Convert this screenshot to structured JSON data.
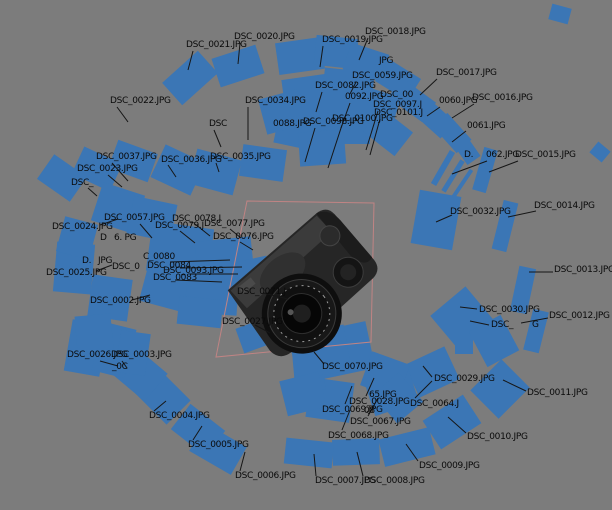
{
  "scene": {
    "width": 612,
    "height": 510,
    "background_color": "#7c7c7c",
    "plane_color": "#3b76b5",
    "label_text_color": "#0a0a0a",
    "leader_color": "#161616",
    "bbox_color": "#c08484",
    "model_description": "dslr-camera-3d-reconstruction"
  },
  "bbox": {
    "points": "247,201 374,203 371,342 216,357"
  },
  "planes": [
    [
      190,
      78,
      48,
      30,
      -42
    ],
    [
      238,
      66,
      46,
      30,
      -18
    ],
    [
      300,
      56,
      46,
      32,
      -8
    ],
    [
      336,
      52,
      42,
      30,
      6
    ],
    [
      366,
      62,
      40,
      28,
      18
    ],
    [
      560,
      14,
      20,
      16,
      15
    ],
    [
      398,
      80,
      38,
      26,
      32
    ],
    [
      412,
      100,
      42,
      24,
      36
    ],
    [
      433,
      117,
      40,
      22,
      42
    ],
    [
      452,
      133,
      36,
      20,
      48
    ],
    [
      466,
      149,
      28,
      16,
      55
    ],
    [
      443,
      168,
      6,
      38,
      30
    ],
    [
      453,
      176,
      5,
      36,
      32
    ],
    [
      462,
      184,
      4,
      34,
      34
    ],
    [
      436,
      220,
      42,
      54,
      10
    ],
    [
      485,
      170,
      14,
      44,
      16
    ],
    [
      505,
      226,
      15,
      50,
      14
    ],
    [
      523,
      290,
      17,
      46,
      12
    ],
    [
      536,
      331,
      16,
      42,
      14
    ],
    [
      500,
      389,
      44,
      40,
      -45
    ],
    [
      462,
      318,
      46,
      44,
      -40
    ],
    [
      494,
      341,
      40,
      36,
      62
    ],
    [
      432,
      372,
      44,
      36,
      -25
    ],
    [
      340,
      351,
      62,
      48,
      -12
    ],
    [
      464,
      345,
      18,
      18,
      0
    ],
    [
      391,
      390,
      46,
      40,
      -18
    ],
    [
      330,
      400,
      44,
      40,
      8
    ],
    [
      309,
      374,
      30,
      34,
      -5
    ],
    [
      452,
      422,
      48,
      34,
      -33
    ],
    [
      407,
      447,
      52,
      28,
      -14
    ],
    [
      356,
      452,
      47,
      26,
      -2
    ],
    [
      309,
      453,
      48,
      26,
      6
    ],
    [
      218,
      449,
      48,
      32,
      30
    ],
    [
      198,
      430,
      44,
      32,
      38
    ],
    [
      163,
      397,
      44,
      34,
      45
    ],
    [
      140,
      374,
      42,
      36,
      40
    ],
    [
      86,
      348,
      36,
      52,
      10
    ],
    [
      114,
      350,
      34,
      50,
      14
    ],
    [
      133,
      353,
      30,
      42,
      8
    ],
    [
      74,
      268,
      38,
      50,
      5
    ],
    [
      110,
      298,
      40,
      42,
      8
    ],
    [
      94,
      333,
      36,
      36,
      -5
    ],
    [
      77,
      238,
      34,
      36,
      15
    ],
    [
      62,
      178,
      40,
      30,
      35
    ],
    [
      97,
      169,
      42,
      30,
      25
    ],
    [
      133,
      161,
      42,
      30,
      20
    ],
    [
      178,
      170,
      44,
      36,
      25
    ],
    [
      215,
      172,
      46,
      36,
      15
    ],
    [
      263,
      163,
      44,
      32,
      8
    ],
    [
      118,
      208,
      44,
      40,
      18
    ],
    [
      152,
      219,
      44,
      38,
      12
    ],
    [
      180,
      250,
      62,
      50,
      8
    ],
    [
      225,
      262,
      56,
      46,
      -6
    ],
    [
      170,
      285,
      52,
      46,
      15
    ],
    [
      212,
      293,
      52,
      42,
      4
    ],
    [
      248,
      280,
      46,
      40,
      -12
    ],
    [
      200,
      312,
      44,
      28,
      6
    ],
    [
      312,
      97,
      56,
      42,
      -8
    ],
    [
      348,
      88,
      50,
      36,
      6
    ],
    [
      302,
      128,
      50,
      40,
      12
    ],
    [
      342,
      122,
      56,
      44,
      0
    ],
    [
      374,
      107,
      46,
      34,
      18
    ],
    [
      388,
      132,
      40,
      30,
      38
    ],
    [
      322,
      148,
      46,
      34,
      -4
    ],
    [
      282,
      112,
      40,
      36,
      -15
    ],
    [
      320,
      352,
      56,
      46,
      -10
    ],
    [
      303,
      394,
      40,
      36,
      -14
    ],
    [
      385,
      375,
      40,
      36,
      20
    ],
    [
      398,
      398,
      38,
      34,
      50
    ],
    [
      254,
      336,
      30,
      26,
      -20
    ],
    [
      600,
      152,
      16,
      14,
      40
    ]
  ],
  "labels": [
    {
      "text": "DSC_0021.JPG",
      "x": 186,
      "y": 40,
      "leader": [
        193,
        51,
        188,
        70
      ]
    },
    {
      "text": "DSC_0020.JPG",
      "x": 234,
      "y": 32,
      "leader": [
        240,
        43,
        238,
        64
      ]
    },
    {
      "text": "DSC_0018.JPG",
      "x": 365,
      "y": 27,
      "leader": [
        368,
        38,
        359,
        60
      ]
    },
    {
      "text": "DSC_0019.JPG",
      "x": 322,
      "y": 35,
      "leader": [
        323,
        46,
        320,
        67
      ]
    },
    {
      "text": "DSC_0017.JPG",
      "x": 436,
      "y": 68,
      "leader": [
        437,
        79,
        420,
        95
      ]
    },
    {
      "text": "DSC_0016.JPG",
      "x": 472,
      "y": 93,
      "leader": [
        474,
        104,
        452,
        118
      ]
    },
    {
      "text": "0060.JPG",
      "x": 439,
      "y": 96,
      "leader": [
        440,
        107,
        427,
        116
      ]
    },
    {
      "text": "0061.JPG",
      "x": 467,
      "y": 121,
      "leader": [
        466,
        131,
        452,
        142
      ]
    },
    {
      "text": "D.",
      "x": 464,
      "y": 150
    },
    {
      "text": "062.JPG",
      "x": 486,
      "y": 150,
      "leader": [
        487,
        161,
        452,
        174
      ]
    },
    {
      "text": "DSC_0015.JPG",
      "x": 515,
      "y": 150,
      "leader": [
        518,
        161,
        489,
        172
      ]
    },
    {
      "text": "DSC_0014.JPG",
      "x": 534,
      "y": 201,
      "leader": [
        536,
        211,
        508,
        217
      ]
    },
    {
      "text": "DSC_0032.JPG",
      "x": 450,
      "y": 207,
      "leader": [
        452,
        215,
        436,
        222
      ]
    },
    {
      "text": "DSC_0013.JPG",
      "x": 554,
      "y": 265,
      "leader": [
        553,
        272,
        529,
        272
      ]
    },
    {
      "text": "DSC_0030.JPG",
      "x": 479,
      "y": 305,
      "leader": [
        477,
        309,
        460,
        307
      ]
    },
    {
      "text": "DSC_0012.JPG",
      "x": 549,
      "y": 311,
      "leader": [
        548,
        318,
        521,
        323
      ]
    },
    {
      "text": "DSC_",
      "x": 491,
      "y": 320,
      "leader": [
        489,
        325,
        470,
        321
      ]
    },
    {
      "text": "G",
      "x": 532,
      "y": 320
    },
    {
      "text": "DSC_0011.JPG",
      "x": 527,
      "y": 388,
      "leader": [
        526,
        391,
        503,
        380
      ]
    },
    {
      "text": "DSC_0029.JPG",
      "x": 434,
      "y": 374,
      "leader": [
        432,
        377,
        423,
        366
      ]
    },
    {
      "text": "DSC_0010.JPG",
      "x": 467,
      "y": 432,
      "leader": [
        466,
        433,
        448,
        417
      ]
    },
    {
      "text": "DSC_0009.JPG",
      "x": 419,
      "y": 461,
      "leader": [
        418,
        461,
        406,
        444
      ]
    },
    {
      "text": "DSC_0008.JPG",
      "x": 364,
      "y": 476,
      "leader": [
        363,
        476,
        357,
        452
      ]
    },
    {
      "text": "DSC_0007.JPG",
      "x": 315,
      "y": 476,
      "leader": [
        316,
        476,
        314,
        454
      ]
    },
    {
      "text": "DSC_0006.JPG",
      "x": 235,
      "y": 471,
      "leader": [
        240,
        471,
        245,
        452
      ]
    },
    {
      "text": "DSC_0005.JPG",
      "x": 188,
      "y": 440,
      "leader": [
        193,
        440,
        202,
        426
      ]
    },
    {
      "text": "DSC_0004.JPG",
      "x": 149,
      "y": 411,
      "leader": [
        154,
        411,
        166,
        401
      ]
    },
    {
      "text": "DSC_0026.JPG",
      "x": 67,
      "y": 350,
      "leader": [
        100,
        361,
        118,
        366
      ]
    },
    {
      "text": "DSC_0003.JPG",
      "x": 111,
      "y": 350,
      "leader": [
        122,
        361,
        127,
        368
      ]
    },
    {
      "text": "_0C",
      "x": 112,
      "y": 362
    },
    {
      "text": "DSC_0025.JPG",
      "x": 46,
      "y": 268,
      "leader": [
        96,
        271,
        112,
        265
      ]
    },
    {
      "text": "DSC_0024.JPG",
      "x": 52,
      "y": 222,
      "leader": [
        100,
        225,
        118,
        219
      ]
    },
    {
      "text": "DSC_0023.JPG",
      "x": 77,
      "y": 164,
      "leader": [
        108,
        175,
        122,
        187
      ]
    },
    {
      "text": "DSC_0037.JPG",
      "x": 96,
      "y": 152,
      "leader": [
        112,
        163,
        128,
        181
      ]
    },
    {
      "text": "DSC_",
      "x": 71,
      "y": 178,
      "leader": [
        88,
        188,
        97,
        196
      ]
    },
    {
      "text": "DSC_0022.JPG",
      "x": 110,
      "y": 96,
      "leader": [
        117,
        107,
        128,
        122
      ]
    },
    {
      "text": "DSC_0036.JPG",
      "x": 161,
      "y": 155,
      "leader": [
        168,
        165,
        176,
        177
      ]
    },
    {
      "text": "DSC_0035.JPG",
      "x": 210,
      "y": 152,
      "leader": [
        216,
        163,
        219,
        172
      ]
    },
    {
      "text": "DSC_0034.JPG",
      "x": 245,
      "y": 96,
      "leader": [
        248,
        107,
        248,
        140
      ]
    },
    {
      "text": "DSC",
      "x": 209,
      "y": 119,
      "leader": [
        214,
        130,
        221,
        147
      ]
    },
    {
      "text": "0088.JPG",
      "x": 273,
      "y": 119
    },
    {
      "text": "DSC_0059.JPG",
      "x": 352,
      "y": 71,
      "leader": [
        356,
        82,
        350,
        94
      ]
    },
    {
      "text": "JPG",
      "x": 379,
      "y": 56
    },
    {
      "text": "DSC_0082.JPG",
      "x": 315,
      "y": 81,
      "leader": [
        322,
        92,
        316,
        112
      ]
    },
    {
      "text": "0092.JPG",
      "x": 345,
      "y": 92,
      "leader": [
        350,
        103,
        341,
        128
      ]
    },
    {
      "text": "DSC_00",
      "x": 380,
      "y": 90
    },
    {
      "text": "DSC_0097.J",
      "x": 373,
      "y": 100,
      "leader": [
        378,
        111,
        366,
        150
      ]
    },
    {
      "text": "DSC_0101.J",
      "x": 374,
      "y": 108,
      "leader": [
        380,
        119,
        370,
        155
      ]
    },
    {
      "text": "DSC_0100.JPG",
      "x": 332,
      "y": 114,
      "leader": [
        342,
        125,
        328,
        168
      ]
    },
    {
      "text": "DSC_0098.JPG",
      "x": 303,
      "y": 117,
      "leader": [
        315,
        128,
        305,
        162
      ]
    },
    {
      "text": "DSC_0057.JPG",
      "x": 104,
      "y": 213,
      "leader": [
        140,
        224,
        152,
        238
      ]
    },
    {
      "text": "D",
      "x": 100,
      "y": 233
    },
    {
      "text": "6. PG",
      "x": 114,
      "y": 233
    },
    {
      "text": "DSC_0078.J",
      "x": 172,
      "y": 214,
      "leader": [
        195,
        224,
        210,
        236
      ]
    },
    {
      "text": "DSC_0079.J",
      "x": 155,
      "y": 221,
      "leader": [
        180,
        231,
        195,
        243
      ]
    },
    {
      "text": "DSC_0077.JPG",
      "x": 204,
      "y": 219,
      "leader": [
        230,
        229,
        241,
        238
      ]
    },
    {
      "text": "DSC_0076.JPG",
      "x": 213,
      "y": 232,
      "leader": [
        240,
        242,
        253,
        250
      ]
    },
    {
      "text": "C_0080",
      "x": 143,
      "y": 252,
      "leader": [
        170,
        262,
        230,
        260
      ]
    },
    {
      "text": "DSC_0084",
      "x": 147,
      "y": 261,
      "leader": [
        180,
        268,
        242,
        267
      ]
    },
    {
      "text": "DSC_0093.JPG",
      "x": 163,
      "y": 266,
      "leader": [
        190,
        274,
        238,
        274
      ]
    },
    {
      "text": "DSC_0083",
      "x": 153,
      "y": 273,
      "leader": [
        175,
        280,
        222,
        282
      ]
    },
    {
      "text": "DSC_0071.J",
      "x": 237,
      "y": 287,
      "leader": [
        263,
        293,
        288,
        299
      ]
    },
    {
      "text": "DSC_0027.JPG",
      "x": 222,
      "y": 317,
      "leader": [
        255,
        325,
        270,
        333
      ]
    },
    {
      "text": "DSC_0002.JPG",
      "x": 90,
      "y": 296,
      "leader": [
        132,
        300,
        150,
        295
      ]
    },
    {
      "text": "D.",
      "x": 82,
      "y": 256
    },
    {
      "text": "JPG",
      "x": 98,
      "y": 256
    },
    {
      "text": "DSC_0",
      "x": 112,
      "y": 262
    },
    {
      "text": "DSC_0070.JPG",
      "x": 322,
      "y": 362,
      "leader": [
        324,
        364,
        314,
        352
      ]
    },
    {
      "text": "65.JPG",
      "x": 369,
      "y": 390
    },
    {
      "text": "DSC_0028.JPG",
      "x": 349,
      "y": 397,
      "leader": [
        366,
        396,
        374,
        378
      ]
    },
    {
      "text": "08",
      "x": 364,
      "y": 406
    },
    {
      "text": "DSC_0069.JPG",
      "x": 322,
      "y": 405,
      "leader": [
        345,
        404,
        352,
        386
      ]
    },
    {
      "text": "DSC_0067.JPG",
      "x": 350,
      "y": 417,
      "leader": [
        368,
        416,
        378,
        398
      ]
    },
    {
      "text": "DSC_0068.JPG",
      "x": 328,
      "y": 431,
      "leader": [
        342,
        430,
        350,
        410
      ]
    },
    {
      "text": "DSC_0064.J",
      "x": 410,
      "y": 399,
      "leader": [
        415,
        398,
        432,
        381
      ]
    }
  ]
}
